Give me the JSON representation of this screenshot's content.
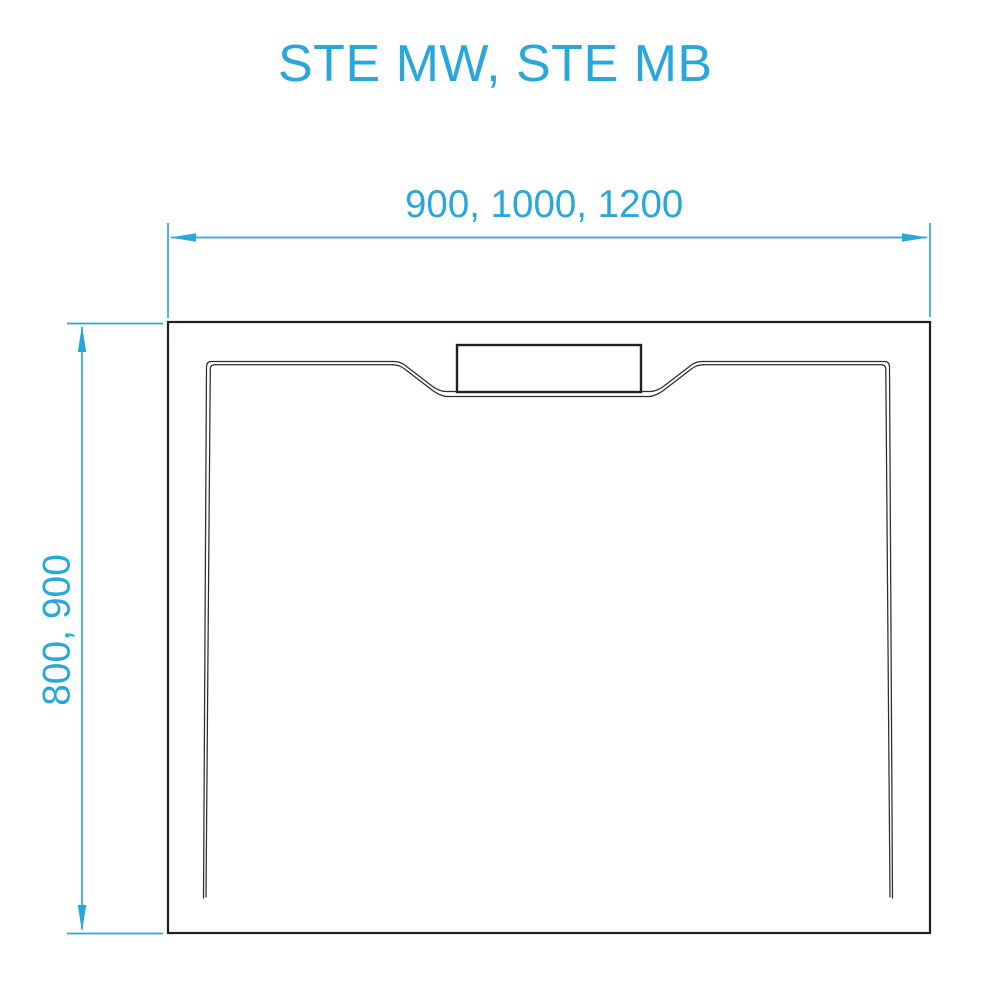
{
  "title": {
    "text": "STE MW, STE MB"
  },
  "colors": {
    "accent": "#29a7db",
    "outline": "#1f1f1f",
    "thin": "#2d2d2d",
    "background": "#ffffff"
  },
  "diagram": {
    "description": "shower-tray-top-view",
    "width_dimension": {
      "label": "900, 1000, 1200",
      "values": [
        900,
        1000,
        1200
      ]
    },
    "depth_dimension": {
      "label": "800, 900",
      "values": [
        800,
        900
      ]
    }
  }
}
